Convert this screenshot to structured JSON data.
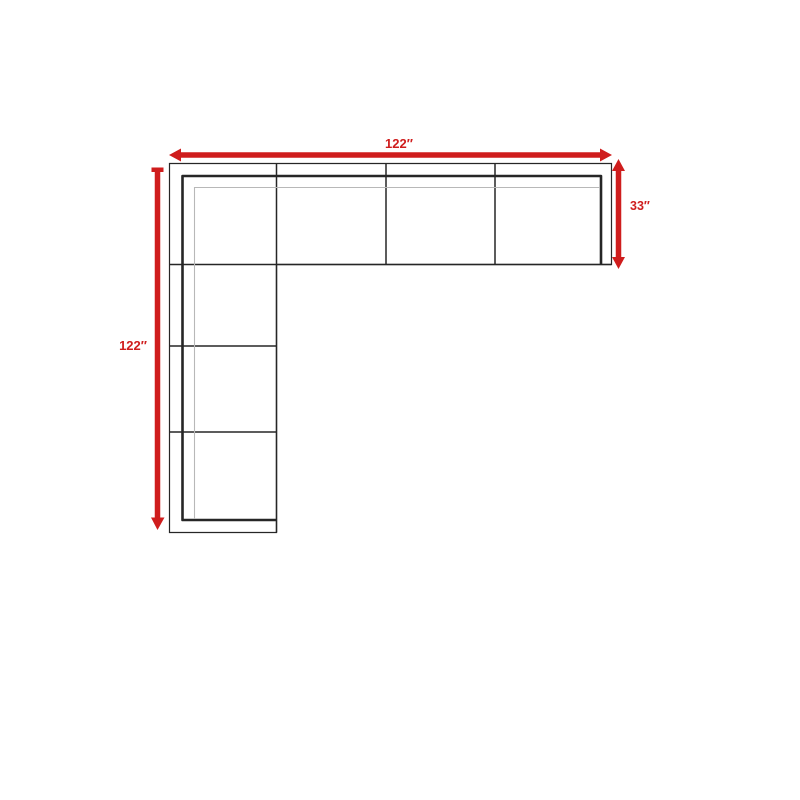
{
  "diagram": {
    "type": "sectional-sofa-dimension-diagram",
    "labels": {
      "top_width": "122″",
      "left_height": "122″",
      "right_depth": "33″"
    },
    "colors": {
      "dimension_red": "#cf1d1d",
      "outline_black": "#262626",
      "seat_line_gray": "#b8b8b8",
      "background": "#ffffff"
    }
  }
}
